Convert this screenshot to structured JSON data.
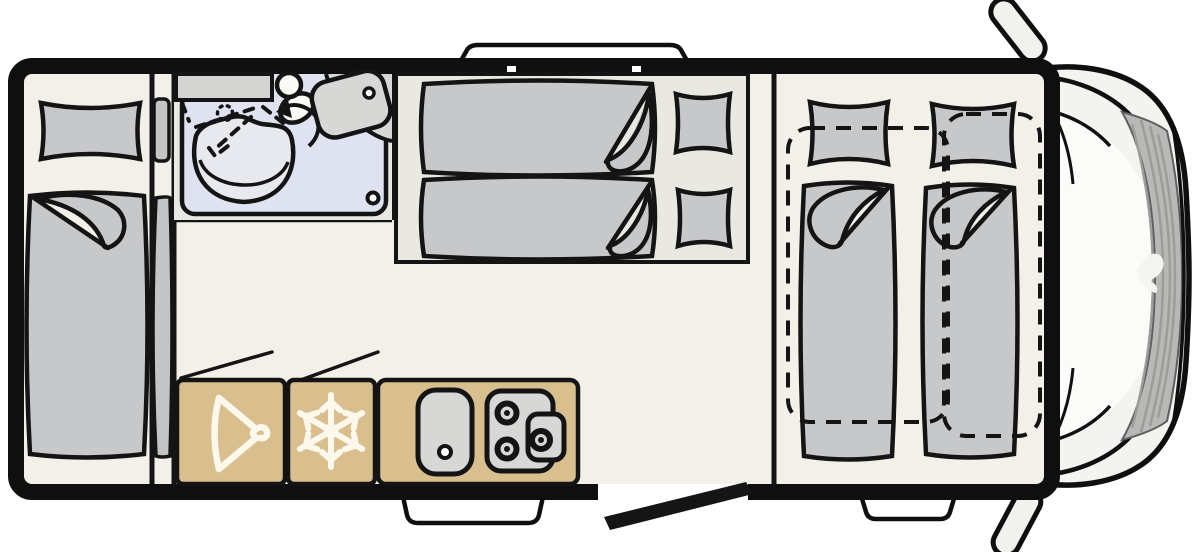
{
  "diagram": {
    "type": "motorhome-floor-plan-top-view",
    "orientation": "cab at right, rear of vehicle at left",
    "colors": {
      "wall": "#0f0f0f",
      "floor": "#f2f0e9",
      "bed_platform_floor": "#eae9e1",
      "furniture_gray": "#c7c8ca",
      "fixture_gray": "#d7d7d5",
      "bathroom_floor": "#dfe3f1",
      "bathroom_bg": "#e9e9e4",
      "kitchen_wood": "#d9bf8e",
      "cab_body": "#f3f3f0",
      "windshield": "#fbfbf9",
      "hood_gray": "#b8b8b6",
      "icon_white": "#fdf8ec",
      "door_black": "#151515"
    },
    "rooms": [
      {
        "name": "rear-bedroom",
        "features": [
          "single-bed-with-folded-blanket",
          "pillow",
          "narrow-bunk-edge"
        ]
      },
      {
        "name": "bathroom",
        "features": [
          "shower-tray",
          "fold-away-shower-dashed",
          "shower-head-dotted",
          "washbasin-bowl",
          "swivel-toilet",
          "rotation-arrow",
          "sink",
          "counter",
          "drain"
        ]
      },
      {
        "name": "mid-bed-area",
        "features": [
          "two-longitudinal-beds",
          "two-pillows",
          "raised-platform"
        ]
      },
      {
        "name": "kitchen",
        "features": [
          "wardrobe",
          "refrigerator",
          "sink-with-drain",
          "three-burner-stove"
        ]
      },
      {
        "name": "front-bedroom",
        "features": [
          "two-single-beds",
          "two-pillows",
          "drop-down-bed-dashed-outline-left",
          "drop-down-bed-dashed-outline-right"
        ]
      },
      {
        "name": "cab",
        "features": [
          "windshield",
          "hood-with-ridges",
          "brand-logo-swirl",
          "mirror-top",
          "mirror-bottom",
          "front-bumper"
        ]
      }
    ],
    "icons": [
      {
        "name": "hanger-icon",
        "meaning": "wardrobe"
      },
      {
        "name": "snowflake-icon",
        "meaning": "refrigerator"
      },
      {
        "name": "burner-icon",
        "meaning": "gas hob",
        "count": 3
      },
      {
        "name": "rotation-arrow-icon",
        "meaning": "swivel toilet"
      },
      {
        "name": "logo-swirl-icon",
        "meaning": "manufacturer logo on hood"
      }
    ],
    "exterior_features": [
      {
        "name": "top-window-bump"
      },
      {
        "name": "kitchen-window-bump"
      },
      {
        "name": "entry-step-bump"
      },
      {
        "name": "entry-door-open-leaf"
      },
      {
        "name": "side-mirror-top"
      },
      {
        "name": "side-mirror-bottom"
      }
    ]
  }
}
